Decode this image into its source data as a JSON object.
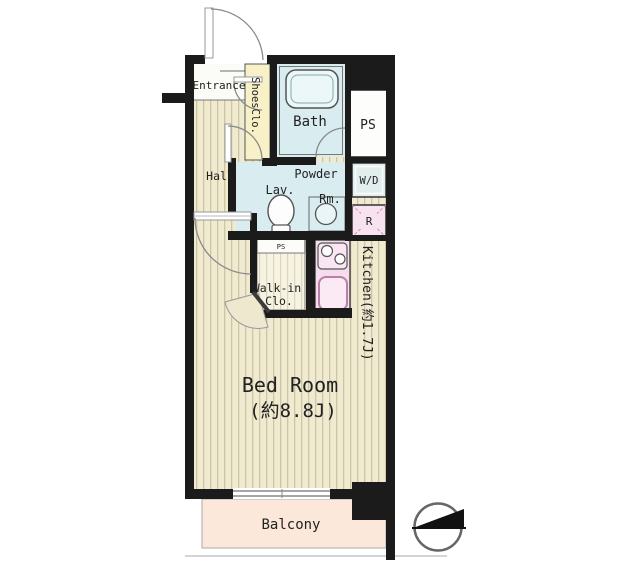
{
  "title": "Apartment floor plan",
  "labels": {
    "entrance": "Entrance",
    "shoes_closet": "ShoesClo.",
    "hall": "Hall",
    "bath": "Bath",
    "pipe_space": "PS",
    "powder_room_1": "Powder",
    "powder_room_2": "Rm.",
    "lavatory": "Lav.",
    "washer_dryer": "W/D",
    "refrigerator": "R",
    "pipe_space_small": "PS",
    "walk_in_closet_1": "Walk-in",
    "walk_in_closet_2": "Clo.",
    "kitchen": "Kitchen(約1.7J)",
    "bedroom_name": "Bed Room",
    "bedroom_size": "(約8.8J)",
    "balcony": "Balcony"
  },
  "icons": {
    "north_arrow": "north-direction-indicator",
    "bathtub": "bathtub",
    "toilet": "toilet",
    "wash_basin": "round-basin",
    "stove": "two-burner-stove",
    "kitchen_sink": "kitchen-sink"
  },
  "colors": {
    "wall": "#1b1b1b",
    "flooring_base": "#f0ead1",
    "flooring_stripe": "#cdc6a3",
    "wet_area_floor": "#d9edf1",
    "closet_floor": "#f7f3e3",
    "shoes_closet_fill": "#f8f1c8",
    "kitchen_counter": "#f7dcee",
    "appliance_pink": "#f8e2f0",
    "washer_dryer_fill": "#e2edee",
    "balcony_fill": "#fbe8da",
    "text": "#222222"
  }
}
